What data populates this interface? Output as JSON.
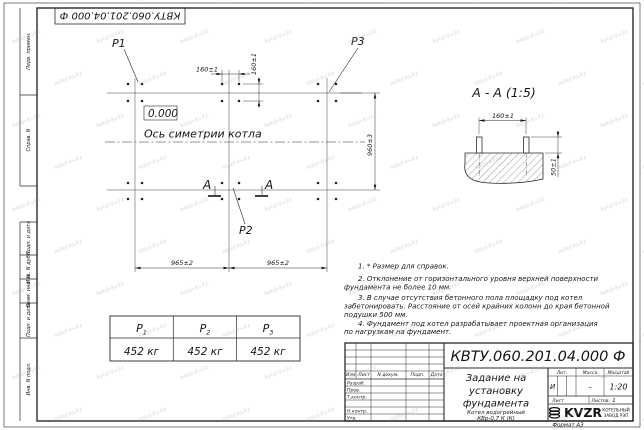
{
  "watermark": {
    "text": "kotel-kv.kz"
  },
  "frame": {
    "doc_number_top": "КВТУ.060.201.04.000 Ф",
    "margin_labels": {
      "perv": "Перв. примен.",
      "sprav": "Справ. N",
      "podp1": "Подп. и дата",
      "inv_dubl": "Инв. N дубл.",
      "vzam": "Взам. инв. N",
      "podp2": "Подп. и дата",
      "inv_podl": "Инв. N подл."
    },
    "format_label": "Формат А3"
  },
  "plan": {
    "labels": {
      "p1": "P1",
      "p2": "P2",
      "p3": "P3"
    },
    "level_mark": "0.000",
    "axis_label": "Ось симетрии котла",
    "section_letter": "А",
    "dims": {
      "d160h": "160±1",
      "d160v": "160±1",
      "d960": "960±3",
      "d965l": "965±2",
      "d965r": "965±2"
    }
  },
  "section": {
    "title": "А - А (1:5)",
    "dims": {
      "d160": "160±1",
      "d50": "50±1"
    }
  },
  "notes": {
    "lines": [
      "1. * Размер для справок.",
      "2. Отклонение от горизонтального уровня верхней поверхности",
      "фундамента не более 10 мм.",
      "3. В случае отсутствия бетонного пола площадку под котел",
      "забетонировать. Расстояние от осей крайних колонн до края бетонной",
      "подушки 500 мм.",
      "4. Фундамент под котел разрабатывает проектная организация",
      "по нагрузкам на фундамент."
    ]
  },
  "load_table": {
    "columns": [
      {
        "name": "P",
        "sub": "1",
        "value": "452 кг"
      },
      {
        "name": "P",
        "sub": "2",
        "value": "452 кг"
      },
      {
        "name": "P",
        "sub": "3",
        "value": "452 кг"
      }
    ]
  },
  "title_block": {
    "doc_number": "КВТУ.060.201.04.000 Ф",
    "title_lines": [
      "Задание на",
      "установку",
      "фундамента"
    ],
    "product_lines": [
      "Котел водогрейный",
      "КВр-0,7 К (К)"
    ],
    "rev_header": {
      "izm": "Изм. Лист",
      "ndoc": "N докум.",
      "podp": "Подп.",
      "data": "Дата"
    },
    "roles": {
      "razrab": "Разраб.",
      "prov": "Пров.",
      "tkontr": "Т.контр.",
      "nkontr": "Н.контр.",
      "utv": "Утв."
    },
    "props": {
      "lit_label": "Лит.",
      "mass_label": "Масса",
      "scale_label": "Масштаб",
      "lit": "И",
      "mass": "–",
      "scale": "1:20",
      "sheet_label": "Лист",
      "sheets_label": "Листов",
      "sheets": "1"
    },
    "company": {
      "logo": "KVZR",
      "line1": "КОТЕЛЬНЫЙ",
      "line2": "ЗАВОД РЭП"
    }
  }
}
